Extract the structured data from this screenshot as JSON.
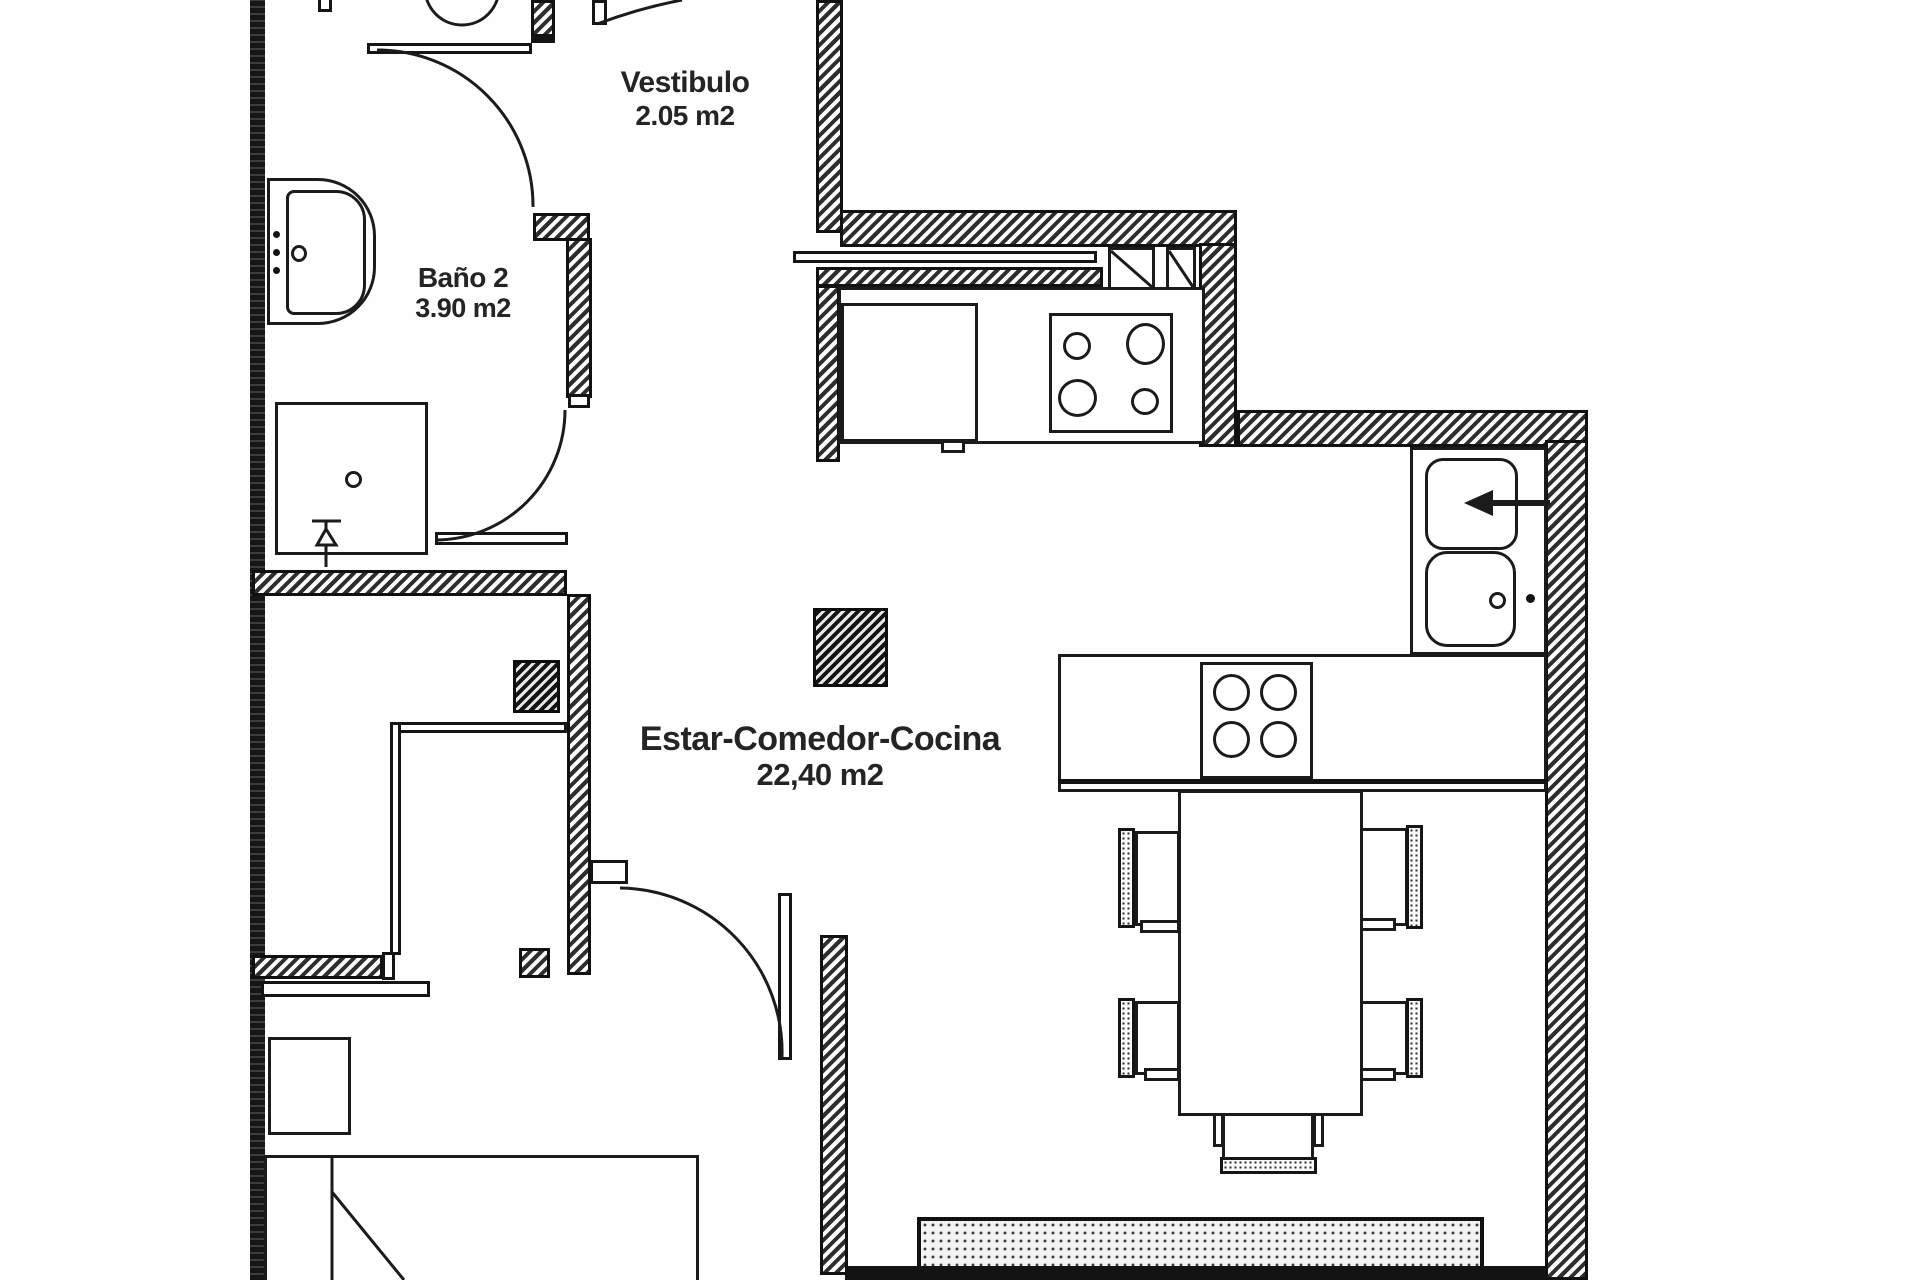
{
  "document": {
    "type": "apartment-floor-plan"
  },
  "rooms": {
    "vestibulo": {
      "name": "Vestibulo",
      "area": "2.05 m2"
    },
    "bano2": {
      "name": "Baño 2",
      "area": "3.90 m2"
    },
    "estar": {
      "name": "Estar-Comedor-Cocina",
      "area": "22,40 m2"
    }
  },
  "fixtures": [
    "toilet",
    "washbasin",
    "shower-tray",
    "shower-valve",
    "entry-door",
    "bathroom-door",
    "living-room-door",
    "fridge",
    "cooktop",
    "island-cooktop",
    "kitchen-sink",
    "sink-drainer",
    "dining-table",
    "chairs",
    "bed",
    "nightstand",
    "closet",
    "rug"
  ],
  "colors": {
    "line": "#1b1b1b",
    "paper": "#ffffff",
    "wall_fill": "#2e2e2e"
  }
}
